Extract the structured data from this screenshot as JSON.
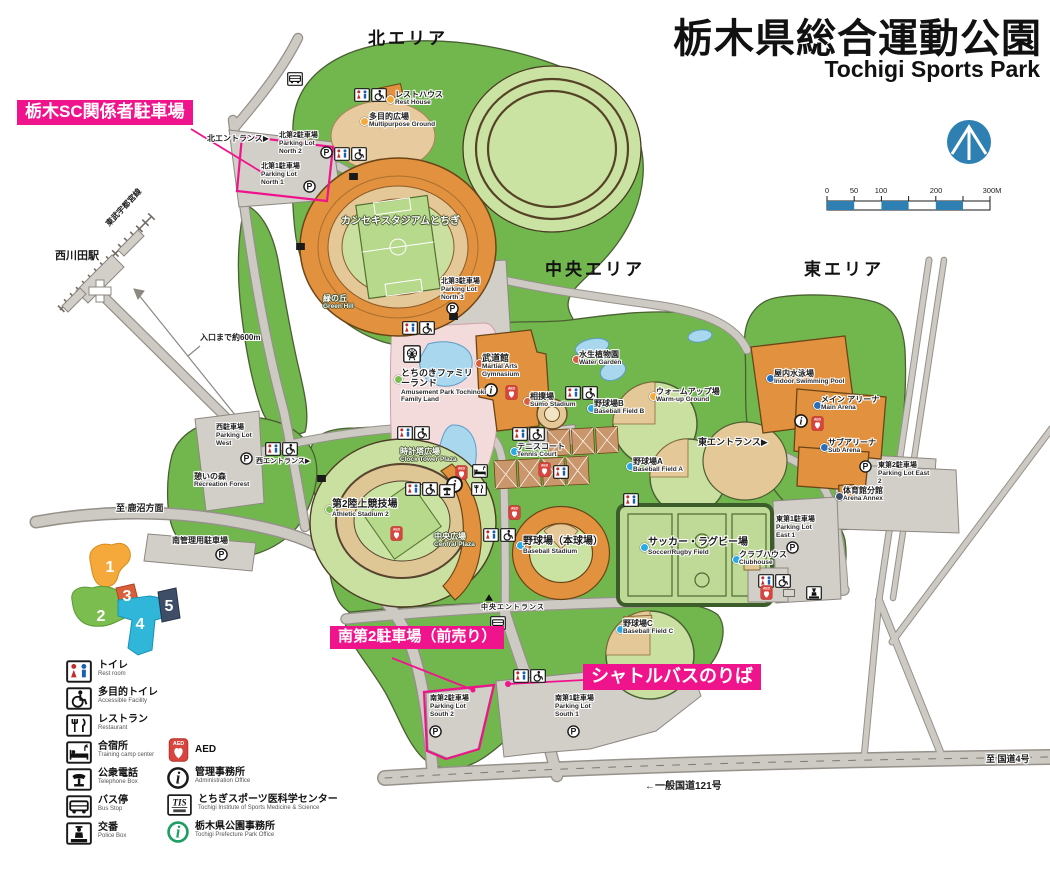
{
  "title": {
    "ja": "栃木県総合運動公園",
    "en": "Tochigi Sports Park"
  },
  "areas": {
    "north": "北エリア",
    "central": "中央エリア",
    "east": "東エリア"
  },
  "callouts": {
    "sc_parking": "栃木SC関係者駐車場",
    "south2_presale": "南第2駐車場（前売り）",
    "shuttle_bus": "シャトルバスのりば"
  },
  "facilities": {
    "rest_house": {
      "ja": "レストハウス",
      "en": "Rest House"
    },
    "multipurpose": {
      "ja": "多目的広場",
      "en": "Multipurpose Ground"
    },
    "kanseki": {
      "ja": "カンセキスタジアムとちぎ",
      "en": ""
    },
    "green_hill": {
      "ja": "緑の丘",
      "en": "Green Hill"
    },
    "lot_n2": {
      "ja": "北第2駐車場",
      "en": "Parking Lot North 2"
    },
    "lot_n1": {
      "ja": "北第1駐車場",
      "en": "Parking Lot North 1"
    },
    "lot_n3": {
      "ja": "北第3駐車場",
      "en": "Parking Lot North 3"
    },
    "family_land": {
      "ja": "とちのきファミリーランド",
      "en": "Amusement Park Tochinoki Family Land"
    },
    "budokan": {
      "ja": "武道館",
      "en": "Martial Arts Gymnasium"
    },
    "water_garden": {
      "ja": "水生植物園",
      "en": "Water Garden"
    },
    "sumo": {
      "ja": "相撲場",
      "en": "Sumo Stadium"
    },
    "field_b": {
      "ja": "野球場B",
      "en": "Baseball Field B"
    },
    "warmup": {
      "ja": "ウォームアップ場",
      "en": "Warm-up Ground"
    },
    "tennis": {
      "ja": "テニスコート",
      "en": "Tennis Court"
    },
    "field_a": {
      "ja": "野球場A",
      "en": "Baseball Field A"
    },
    "clock_plaza": {
      "ja": "時計塔広場",
      "en": "Clock Tower Plaza"
    },
    "central_plaza": {
      "ja": "中央広場",
      "en": "Central Plaza"
    },
    "athletic2": {
      "ja": "第2陸上競技場",
      "en": "Athletic Stadium 2"
    },
    "baseball_main": {
      "ja": "野球場（本球場）",
      "en": "Baseball Stadium"
    },
    "soccer_rugby": {
      "ja": "サッカー・ラグビー場",
      "en": "Soccer/Rugby Field"
    },
    "clubhouse": {
      "ja": "クラブハウス",
      "en": "Clubhouse"
    },
    "field_c": {
      "ja": "野球場C",
      "en": "Baseball Field C"
    },
    "pool": {
      "ja": "屋内水泳場",
      "en": "Indoor Swimming Pool"
    },
    "main_arena": {
      "ja": "メイン アリーナ",
      "en": "Main Arena"
    },
    "sub_arena": {
      "ja": "サブアリーナ",
      "en": "Sub Arena"
    },
    "annex": {
      "ja": "体育館分館",
      "en": "Arena Annex"
    },
    "lot_e2": {
      "ja": "東第2駐車場",
      "en": "Parking Lot East 2"
    },
    "lot_e1": {
      "ja": "東第1駐車場",
      "en": "Parking Lot East 1"
    },
    "lot_w": {
      "ja": "西駐車場",
      "en": "Parking Lot West"
    },
    "forest": {
      "ja": "憩いの森",
      "en": "Recreation Forest"
    },
    "lot_s_mgmt": {
      "ja": "南管理用駐車場",
      "en": ""
    },
    "lot_s1": {
      "ja": "南第1駐車場",
      "en": "Parking Lot South 1"
    },
    "lot_s2": {
      "ja": "南第2駐車場",
      "en": "Parking Lot South 2"
    }
  },
  "entrances": {
    "north": "北エントランス▶",
    "west": "西エントランス▶",
    "central": "中央エントランス",
    "east": "東エントランス▶"
  },
  "transit": {
    "station": "西川田駅",
    "rail_line": "東武宇都宮線",
    "distance": "入口まで約600m",
    "kanuma": "至 鹿沼方面",
    "route121": "一般国道121号",
    "route121_arrow": "←",
    "route4": "至 国道4号"
  },
  "scale": {
    "labels": [
      "0",
      "50",
      "100",
      "200",
      "300M"
    ]
  },
  "minimap": {
    "labels": [
      "1",
      "2",
      "3",
      "4",
      "5"
    ]
  },
  "legend": {
    "left": [
      {
        "ja": "トイレ",
        "en": "Rest room"
      },
      {
        "ja": "多目的トイレ",
        "en": "Accessible Facility"
      },
      {
        "ja": "レストラン",
        "en": "Restaurant"
      },
      {
        "ja": "合宿所",
        "en": "Training camp center"
      },
      {
        "ja": "公衆電話",
        "en": "Telephone Box"
      },
      {
        "ja": "バス停",
        "en": "Bus Stop"
      },
      {
        "ja": "交番",
        "en": "Police Box"
      }
    ],
    "right": [
      {
        "ja": "AED",
        "en": ""
      },
      {
        "ja": "管理事務所",
        "en": "Administration Office"
      },
      {
        "ja": "とちぎスポーツ医科学センター",
        "en": "Tochigi Institute of Sports Medicine & Science"
      },
      {
        "ja": "栃木県公園事務所",
        "en": "Tochigi Prefecture Park Office"
      }
    ]
  },
  "icons": {
    "parking": "P",
    "info": "i",
    "aed": "AED",
    "tis": "TIS"
  },
  "colors": {
    "accent_pink": "#F0148C",
    "park_green": "#72B74E",
    "field_green": "#C9E0A0",
    "stadium_orange": "#E2923F",
    "track_beige": "#E5C897",
    "road_gray": "#CDC9C3",
    "water_blue": "#A9D7EE",
    "scale_teal": "#2E7FB2",
    "dot_orange": "#F5A93B",
    "dot_green": "#7CBD4F",
    "dot_red": "#D95F3B",
    "dot_cyan": "#29ABE2",
    "dot_blue": "#2A6EBB",
    "dot_navy": "#3E4E66"
  }
}
